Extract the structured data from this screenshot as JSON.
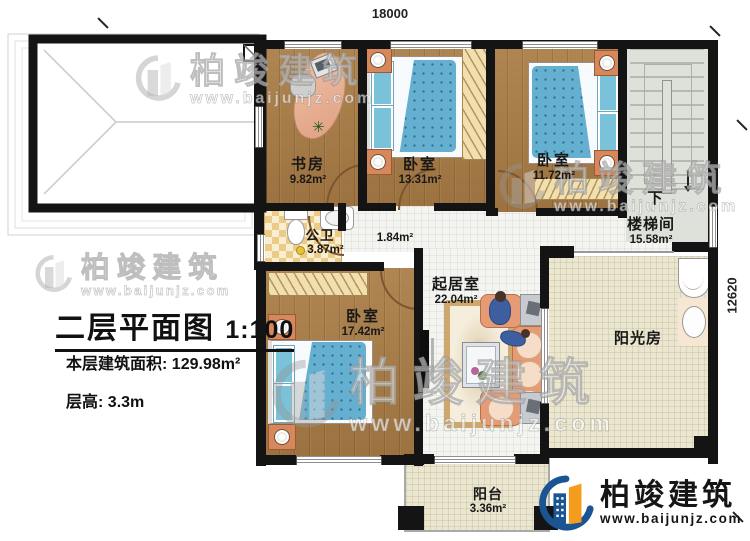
{
  "dimensions": {
    "top": "18000",
    "right": "12620"
  },
  "title_block": {
    "title": "二层平面图",
    "scale": "1:100",
    "area_label": "本层建筑面积:",
    "area_value": "129.98m²",
    "floor_height_label": "层高:",
    "floor_height_value": "3.3m"
  },
  "rooms": {
    "study": {
      "name": "书房",
      "area": "9.82m²"
    },
    "bedroom_top": {
      "name": "卧室",
      "area": "13.31m²"
    },
    "bedroom_right": {
      "name": "卧室",
      "area": "11.72m²"
    },
    "bathroom": {
      "name": "公卫",
      "area": "3.87m²"
    },
    "hallway": {
      "area": "1.84m²"
    },
    "stairwell": {
      "name": "楼梯间",
      "area": "15.58m²",
      "direction": "下"
    },
    "living_room": {
      "name": "起居室",
      "area": "22.04m²"
    },
    "bedroom_large": {
      "name": "卧室",
      "area": "17.42m²"
    },
    "sunroom": {
      "name": "阳光房"
    },
    "balcony": {
      "name": "阳台",
      "area": "3.36m²"
    }
  },
  "brand": {
    "name": "柏竣建筑",
    "website": "www.baijunjz.com"
  },
  "watermark": {
    "name": "柏竣建筑",
    "website": "www.baijunjz.com"
  },
  "colors": {
    "wall": "#141414",
    "wood_floor": "#a97c45",
    "bed_blue": "#65afd0",
    "tile": "#eccb86",
    "brand_blue": "#1b5493",
    "brand_orange": "#f59b1e"
  }
}
